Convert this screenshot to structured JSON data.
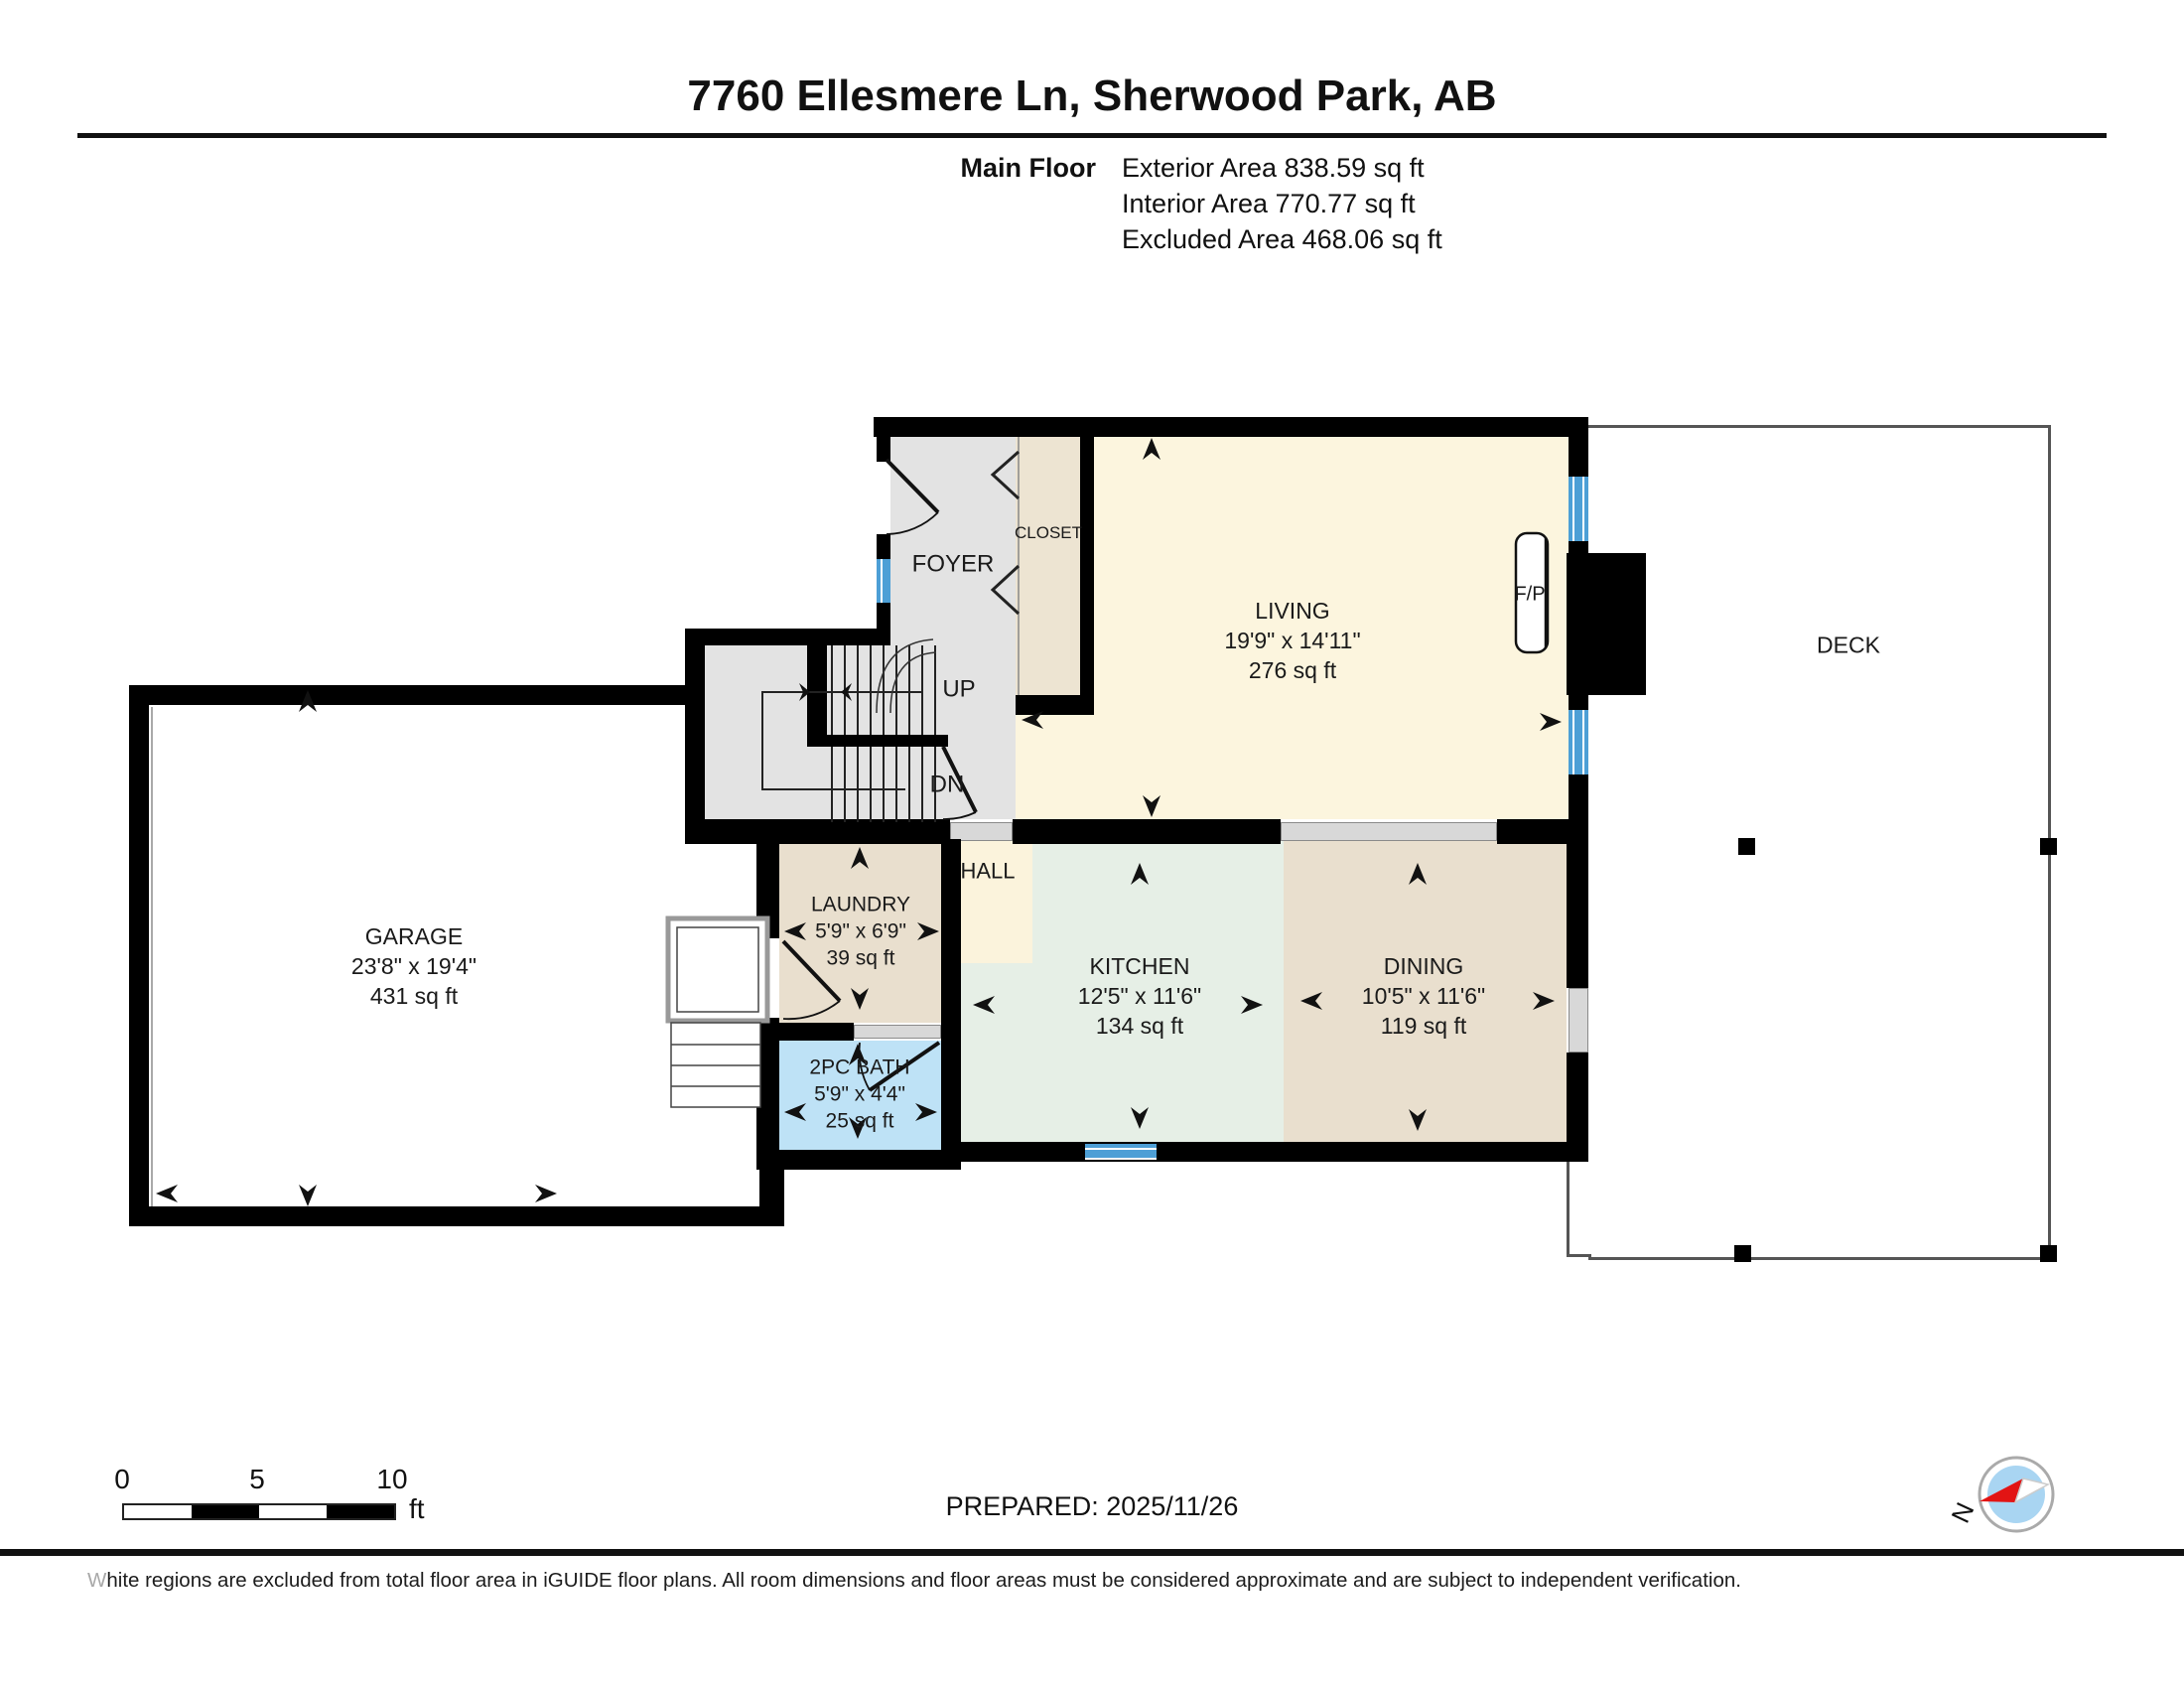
{
  "header": {
    "title": "7760 Ellesmere Ln, Sherwood Park, AB",
    "floor_label": "Main Floor",
    "stats": [
      "Exterior Area 838.59 sq ft",
      "Interior Area 770.77 sq ft",
      "Excluded Area 468.06 sq ft"
    ]
  },
  "rooms": {
    "living": {
      "name": "LIVING",
      "dims": "19'9\" x 14'11\"",
      "area": "276 sq ft"
    },
    "garage": {
      "name": "GARAGE",
      "dims": "23'8\" x 19'4\"",
      "area": "431 sq ft"
    },
    "kitchen": {
      "name": "KITCHEN",
      "dims": "12'5\" x 11'6\"",
      "area": "134 sq ft"
    },
    "dining": {
      "name": "DINING",
      "dims": "10'5\" x 11'6\"",
      "area": "119 sq ft"
    },
    "laundry": {
      "name": "LAUNDRY",
      "dims": "5'9\" x 6'9\"",
      "area": "39 sq ft"
    },
    "bath": {
      "name": "2PC BATH",
      "dims": "5'9\" x 4'4\"",
      "area": "25 sq ft"
    }
  },
  "labels": {
    "foyer": "FOYER",
    "closet": "CLOSET",
    "hall": "HALL",
    "deck": "DECK",
    "fireplace": "F/P",
    "up": "UP",
    "down": "DN",
    "north": "N"
  },
  "scale_bar": {
    "ticks": [
      "0",
      "5",
      "10"
    ],
    "unit": "ft"
  },
  "footer": {
    "prepared": "PREPARED: 2025/11/26",
    "disclaimer": "White regions are excluded from total floor area in iGUIDE floor plans. All room dimensions and floor areas must be considered approximate and are subject to independent verification."
  },
  "colors": {
    "wall": "#000000",
    "foyer_floor": "#E3E3E3",
    "living_floor": "#FCF5DE",
    "hall_floor": "#FBF3DC",
    "closet_floor": "#EDE4D2",
    "kitchen_floor": "#E6EFE6",
    "dining_floor": "#E9DFCE",
    "bath_floor": "#BEE2F6",
    "window_blue": "#4D9FD6",
    "opening_gray": "#D8D8D8",
    "deck_outline": "#555555",
    "compass_blue": "#A9D5F2",
    "compass_red": "#E21414"
  }
}
